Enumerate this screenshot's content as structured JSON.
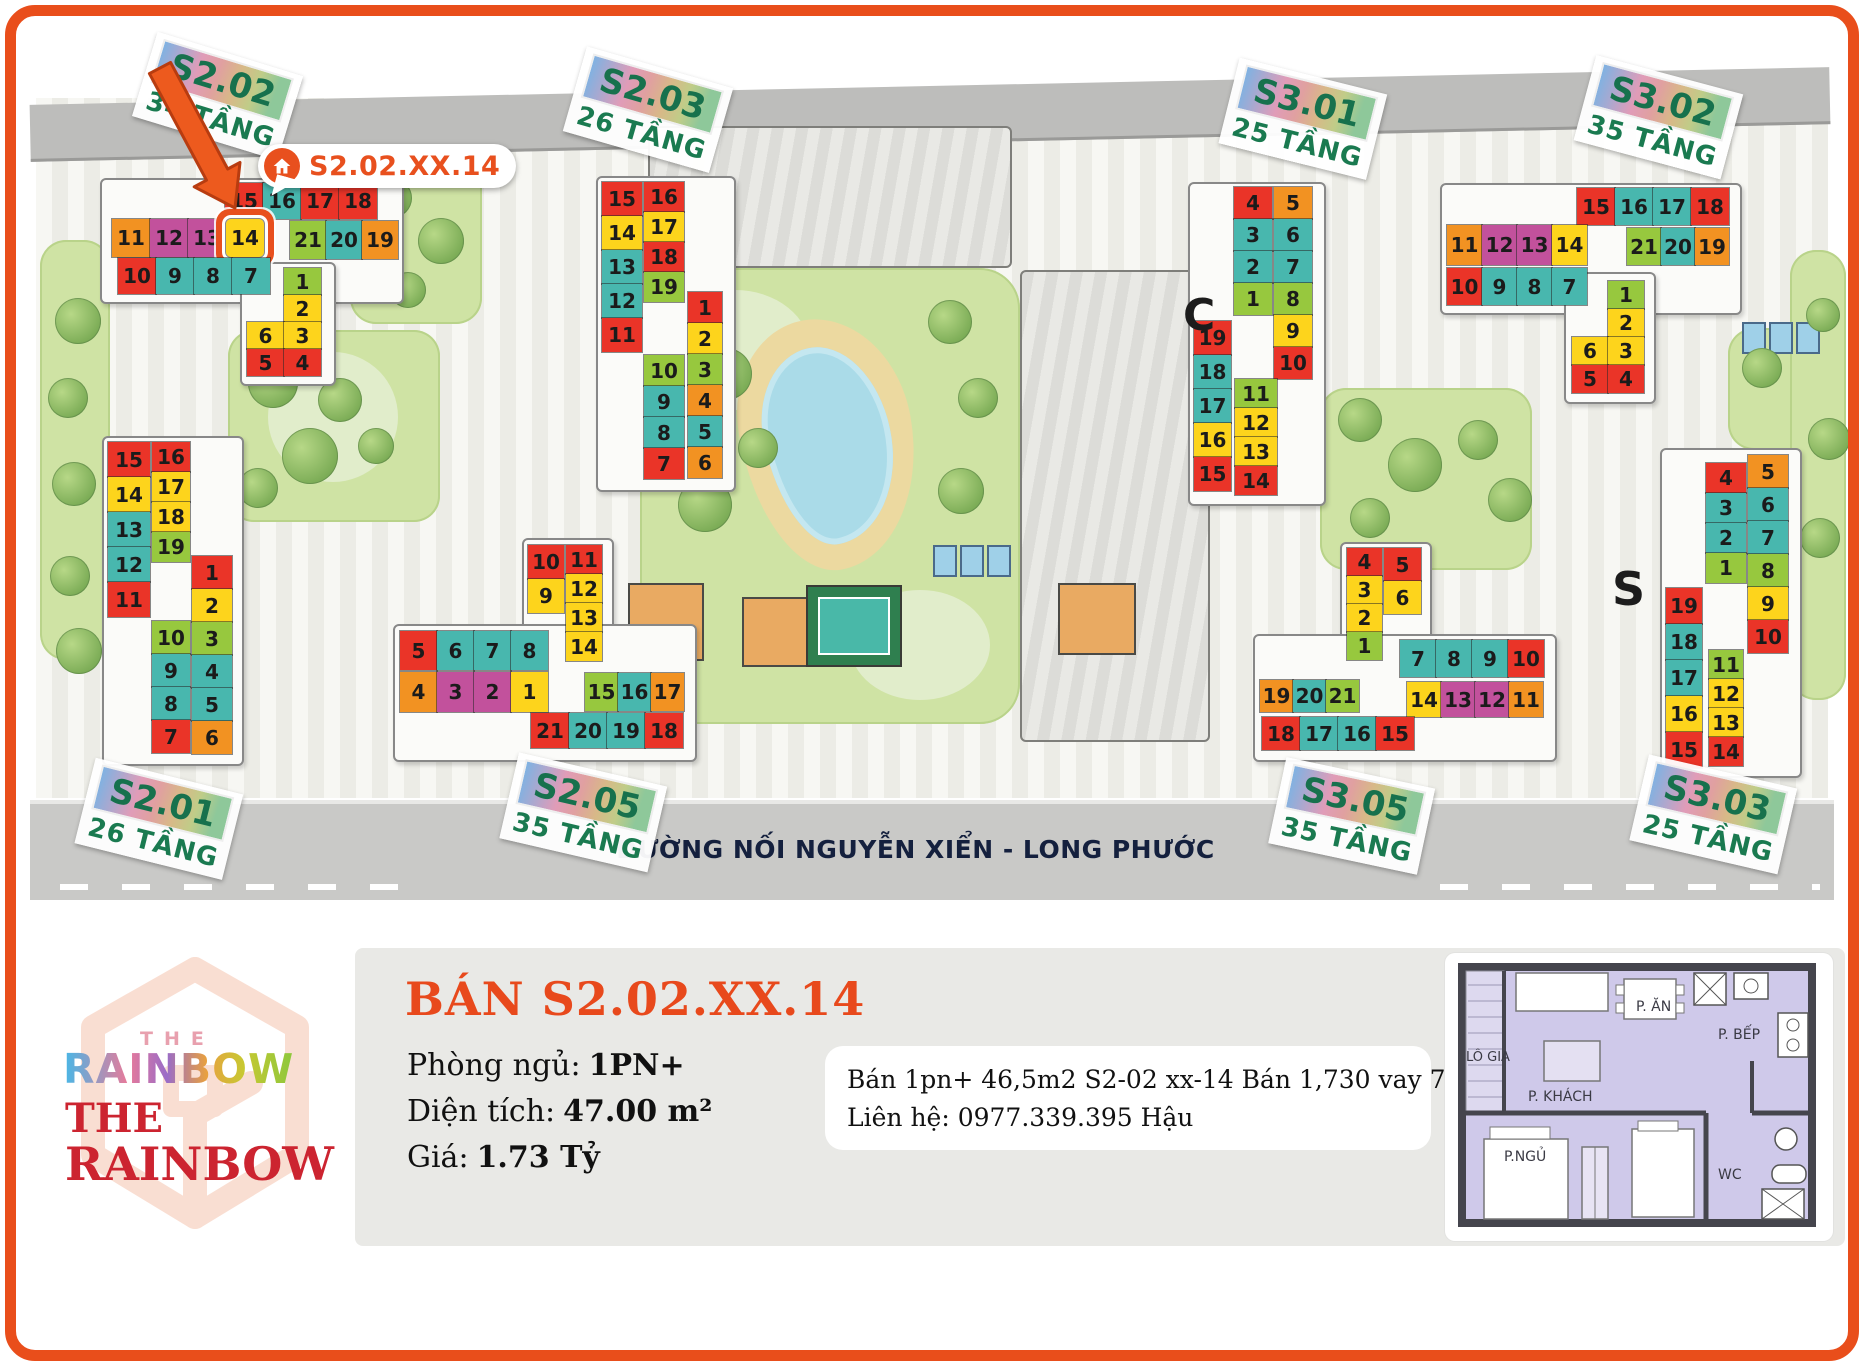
{
  "map": {
    "tooltip_text": "S2.02.XX.14",
    "road_label": "ĐƯỜNG NỐI NGUYỄN XIỂN - LONG PHƯỚC",
    "stray": {
      "c": "C",
      "s": "S"
    },
    "buildings": {
      "s201": {
        "name": "S2.01",
        "floors": "26 TẦNG",
        "groups": {
          "colA": [
            [
              "15",
              "red"
            ],
            [
              "14",
              "yellow"
            ],
            [
              "13",
              "teal"
            ],
            [
              "12",
              "teal"
            ],
            [
              "11",
              "red"
            ]
          ],
          "colB": [
            [
              "16",
              "red"
            ],
            [
              "17",
              "yellow"
            ],
            [
              "18",
              "yellow"
            ],
            [
              "19",
              "green"
            ]
          ],
          "colC": [
            [
              "1",
              "red"
            ],
            [
              "2",
              "yellow"
            ],
            [
              "3",
              "green"
            ],
            [
              "4",
              "teal"
            ],
            [
              "5",
              "teal"
            ],
            [
              "6",
              "orange"
            ]
          ],
          "colB2": [
            [
              "10",
              "green"
            ],
            [
              "9",
              "teal"
            ],
            [
              "8",
              "teal"
            ],
            [
              "7",
              "red"
            ]
          ]
        }
      },
      "s202": {
        "name": "S2.02",
        "floors": "34 TẦNG",
        "groups": {
          "row1": [
            [
              "15",
              "red"
            ],
            [
              "16",
              "teal"
            ],
            [
              "17",
              "red"
            ],
            [
              "18",
              "red"
            ]
          ],
          "row2": [
            [
              "11",
              "orange"
            ],
            [
              "12",
              "magenta"
            ],
            [
              "13",
              "magenta"
            ],
            [
              "14",
              "yellow",
              "sel"
            ]
          ],
          "row2b": [
            [
              "21",
              "green"
            ],
            [
              "20",
              "teal"
            ],
            [
              "19",
              "orange"
            ]
          ],
          "row3": [
            [
              "10",
              "red"
            ],
            [
              "9",
              "teal"
            ],
            [
              "8",
              "teal"
            ],
            [
              "7",
              "teal"
            ]
          ],
          "tail": [
            null,
            [
              "1",
              "green"
            ],
            null,
            [
              "2",
              "yellow"
            ],
            [
              "6",
              "yellow"
            ],
            [
              "3",
              "yellow"
            ],
            [
              "5",
              "red"
            ],
            [
              "4",
              "red"
            ]
          ]
        }
      },
      "s203": {
        "name": "S2.03",
        "floors": "26 TẦNG",
        "groups": {
          "colA": [
            [
              "15",
              "red"
            ],
            [
              "14",
              "yellow"
            ],
            [
              "13",
              "teal"
            ],
            [
              "12",
              "teal"
            ],
            [
              "11",
              "red"
            ]
          ],
          "colB": [
            [
              "16",
              "red"
            ],
            [
              "17",
              "yellow"
            ],
            [
              "18",
              "red"
            ],
            [
              "19",
              "green"
            ]
          ],
          "colC": [
            [
              "1",
              "red"
            ],
            [
              "2",
              "yellow"
            ],
            [
              "3",
              "green"
            ],
            [
              "4",
              "orange"
            ],
            [
              "5",
              "teal"
            ],
            [
              "6",
              "orange"
            ]
          ],
          "colB2": [
            [
              "10",
              "green"
            ],
            [
              "9",
              "teal"
            ],
            [
              "8",
              "teal"
            ],
            [
              "7",
              "red"
            ]
          ]
        }
      },
      "s205": {
        "name": "S2.05",
        "floors": "35 TẦNG",
        "groups": {
          "topL": [
            [
              "10",
              "red"
            ],
            [
              "9",
              "yellow"
            ]
          ],
          "topR": [
            [
              "11",
              "red"
            ],
            [
              "12",
              "yellow"
            ],
            [
              "13",
              "yellow"
            ],
            [
              "14",
              "yellow"
            ]
          ],
          "armL1": [
            [
              "5",
              "red"
            ],
            [
              "6",
              "teal"
            ],
            [
              "7",
              "teal"
            ],
            [
              "8",
              "teal"
            ]
          ],
          "armL2": [
            [
              "4",
              "orange"
            ],
            [
              "3",
              "magenta"
            ],
            [
              "2",
              "magenta"
            ],
            [
              "1",
              "yellow"
            ]
          ],
          "armR1": [
            [
              "15",
              "green"
            ],
            [
              "16",
              "teal"
            ],
            [
              "17",
              "orange"
            ]
          ],
          "armR2": [
            [
              "21",
              "red"
            ],
            [
              "20",
              "teal"
            ],
            [
              "19",
              "teal"
            ],
            [
              "18",
              "red"
            ]
          ]
        }
      },
      "s301": {
        "name": "S3.01",
        "floors": "25 TẦNG",
        "groups": {
          "upL": [
            [
              "4",
              "red"
            ],
            [
              "3",
              "teal"
            ],
            [
              "2",
              "teal"
            ],
            [
              "1",
              "green"
            ]
          ],
          "upR": [
            [
              "5",
              "orange"
            ],
            [
              "6",
              "teal"
            ],
            [
              "7",
              "teal"
            ],
            [
              "8",
              "green"
            ],
            [
              "9",
              "yellow"
            ],
            [
              "10",
              "red"
            ]
          ],
          "loL": [
            [
              "19",
              "red"
            ],
            [
              "18",
              "teal"
            ],
            [
              "17",
              "teal"
            ],
            [
              "16",
              "yellow"
            ],
            [
              "15",
              "red"
            ]
          ],
          "loM": [
            [
              "11",
              "green"
            ],
            [
              "12",
              "yellow"
            ],
            [
              "13",
              "yellow"
            ],
            [
              "14",
              "red"
            ]
          ]
        }
      },
      "s302": {
        "name": "S3.02",
        "floors": "35 TẦNG",
        "groups": {
          "row1": [
            [
              "15",
              "red"
            ],
            [
              "16",
              "teal"
            ],
            [
              "17",
              "teal"
            ],
            [
              "18",
              "red"
            ]
          ],
          "row2": [
            [
              "11",
              "orange"
            ],
            [
              "12",
              "magenta"
            ],
            [
              "13",
              "magenta"
            ],
            [
              "14",
              "yellow"
            ]
          ],
          "row2b": [
            [
              "21",
              "green"
            ],
            [
              "20",
              "teal"
            ],
            [
              "19",
              "orange"
            ]
          ],
          "row3": [
            [
              "10",
              "red"
            ],
            [
              "9",
              "teal"
            ],
            [
              "8",
              "teal"
            ],
            [
              "7",
              "teal"
            ]
          ],
          "tail": [
            null,
            [
              "1",
              "green"
            ],
            null,
            [
              "2",
              "yellow"
            ],
            [
              "6",
              "yellow"
            ],
            [
              "3",
              "yellow"
            ],
            [
              "5",
              "red"
            ],
            [
              "4",
              "red"
            ]
          ]
        }
      },
      "s303": {
        "name": "S3.03",
        "floors": "25 TẦNG",
        "groups": {
          "upL": [
            [
              "4",
              "red"
            ],
            [
              "3",
              "teal"
            ],
            [
              "2",
              "teal"
            ],
            [
              "1",
              "green"
            ]
          ],
          "upR": [
            [
              "5",
              "orange"
            ],
            [
              "6",
              "teal"
            ],
            [
              "7",
              "teal"
            ],
            [
              "8",
              "green"
            ],
            [
              "9",
              "yellow"
            ],
            [
              "10",
              "red"
            ]
          ],
          "loL": [
            [
              "19",
              "red"
            ],
            [
              "18",
              "teal"
            ],
            [
              "17",
              "teal"
            ],
            [
              "16",
              "yellow"
            ],
            [
              "15",
              "red"
            ]
          ],
          "loM": [
            [
              "11",
              "green"
            ],
            [
              "12",
              "yellow"
            ],
            [
              "13",
              "yellow"
            ],
            [
              "14",
              "red"
            ]
          ]
        }
      },
      "s305": {
        "name": "S3.05",
        "floors": "35 TẦNG",
        "groups": {
          "topL": [
            [
              "4",
              "red"
            ],
            [
              "3",
              "yellow"
            ],
            [
              "2",
              "yellow"
            ],
            [
              "1",
              "green"
            ]
          ],
          "topR": [
            [
              "5",
              "red"
            ],
            [
              "6",
              "yellow"
            ]
          ],
          "armR1": [
            [
              "7",
              "teal"
            ],
            [
              "8",
              "teal"
            ],
            [
              "9",
              "teal"
            ],
            [
              "10",
              "red"
            ]
          ],
          "armR2": [
            [
              "14",
              "yellow"
            ],
            [
              "13",
              "magenta"
            ],
            [
              "12",
              "magenta"
            ],
            [
              "11",
              "orange"
            ]
          ],
          "armL1": [
            [
              "19",
              "orange"
            ],
            [
              "20",
              "teal"
            ],
            [
              "21",
              "green"
            ]
          ],
          "armL2": [
            [
              "18",
              "red"
            ],
            [
              "17",
              "teal"
            ],
            [
              "16",
              "teal"
            ],
            [
              "15",
              "red"
            ]
          ]
        }
      }
    }
  },
  "panel": {
    "title": "BÁN S2.02.XX.14",
    "fields": [
      {
        "label": "Phòng ngủ:",
        "value": "1PN+"
      },
      {
        "label": "Diện tích:",
        "value": "47.00 m²"
      },
      {
        "label": "Giá:",
        "value": "1.73 Tỷ"
      }
    ],
    "note_lines": [
      "Bán 1pn+ 46,5m2 S2-02 xx-14 Bán 1,730 vay 70%",
      "Liên hệ: 0977.339.395 Hậu"
    ]
  },
  "logo": {
    "small_the": "THE",
    "small_word": "RAINBOW",
    "the": "THE",
    "word": "RAINBOW"
  },
  "floorplan": {
    "rooms": {
      "an": "P. ĂN",
      "bep": "P. BẾP",
      "logia": "LÔ GIA",
      "khach": "P. KHÁCH",
      "ngu": "P.NGỦ",
      "wc": "WC"
    }
  },
  "colors": {
    "accent_orange": "#E8501E",
    "frame_orange": "#E94E1B",
    "title_orange": "#E8491C",
    "unit_red": "#EA3428",
    "unit_teal": "#48B7AE",
    "unit_yellow": "#FDD41C",
    "unit_orange": "#F29222",
    "unit_green": "#97C83E",
    "unit_magenta": "#C2519C",
    "label_green": "#17714D",
    "logo_red": "#CC2430",
    "plan_lavender": "#CFC9EA"
  }
}
